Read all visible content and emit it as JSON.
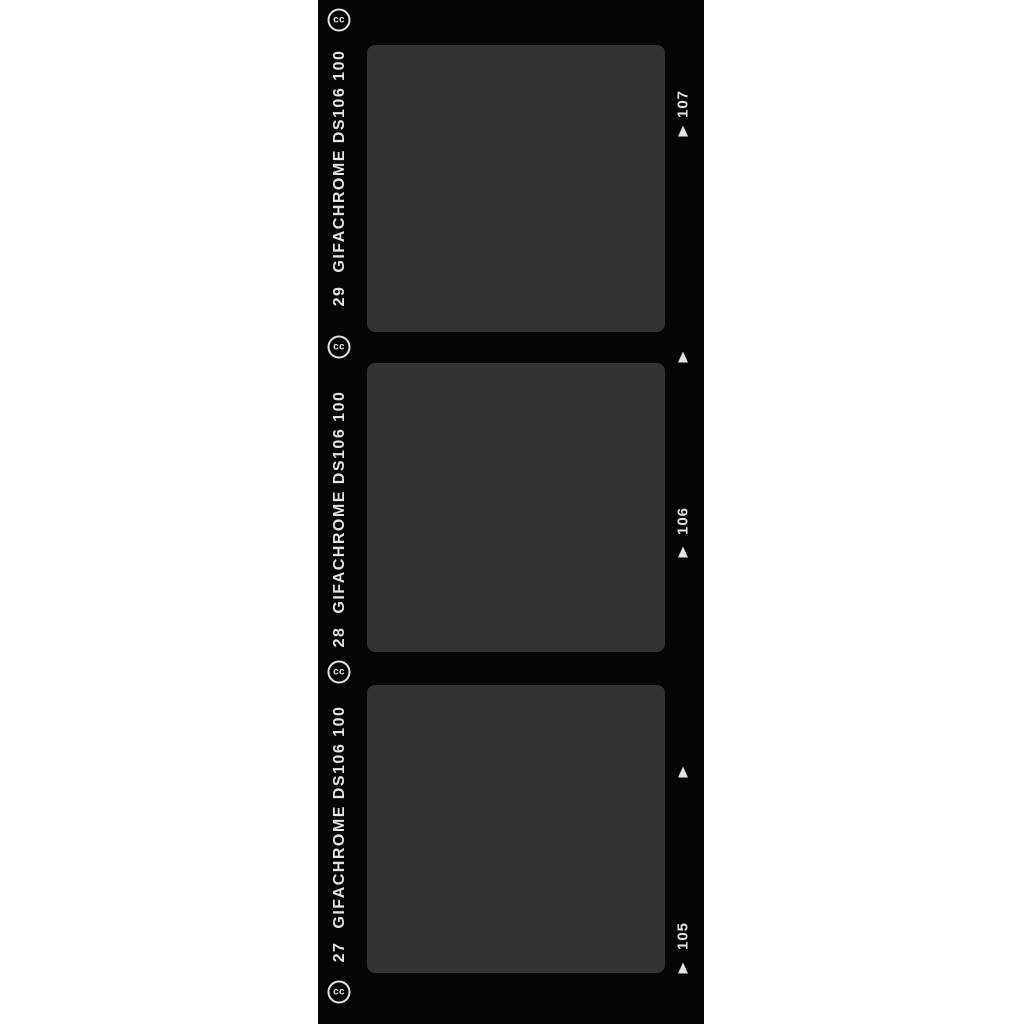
{
  "image": {
    "description": "GIFACHROME film strip with three blank exposed frames",
    "background_color": "#ffffff",
    "strip_color": "#050505",
    "frame_color": "#323232",
    "text_color": "#e3e3e3"
  },
  "strip": {
    "cc_badge_label": "cc",
    "frames": [
      {
        "frame_number": "29",
        "brand": "GIFACHROME DS106 100",
        "edge_number": "107"
      },
      {
        "frame_number": "28",
        "brand": "GIFACHROME DS106 100",
        "edge_number": "106"
      },
      {
        "frame_number": "27",
        "brand": "GIFACHROME DS106 100",
        "edge_number": "105"
      }
    ]
  }
}
